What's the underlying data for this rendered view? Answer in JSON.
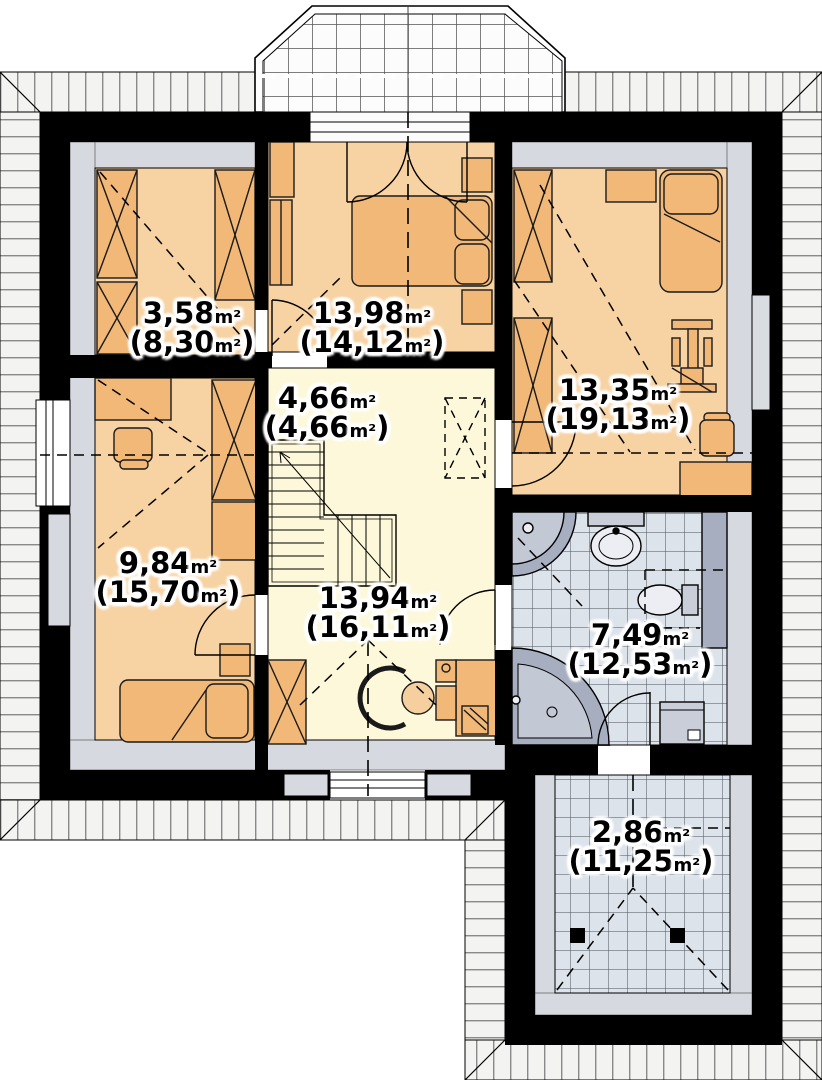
{
  "plan": {
    "type": "floor-plan",
    "floor": "attic storey",
    "rooms": [
      {
        "name": "closet",
        "area_value": "3,58",
        "area_unit": "m²",
        "total_open": "(8,30",
        "total_unit": "m²",
        "total_close": ")"
      },
      {
        "name": "bedroom-top",
        "area_value": "13,98",
        "area_unit": "m²",
        "total_open": "(14,12",
        "total_unit": "m²",
        "total_close": ")"
      },
      {
        "name": "stair-hall",
        "area_value": "4,66",
        "area_unit": "m²",
        "total_open": "(4,66",
        "total_unit": "m²",
        "total_close": ")"
      },
      {
        "name": "bedroom-right",
        "area_value": "13,35",
        "area_unit": "m²",
        "total_open": "(19,13",
        "total_unit": "m²",
        "total_close": ")"
      },
      {
        "name": "bedroom-left",
        "area_value": "9,84",
        "area_unit": "m²",
        "total_open": "(15,70",
        "total_unit": "m²",
        "total_close": ")"
      },
      {
        "name": "hall",
        "area_value": "13,94",
        "area_unit": "m²",
        "total_open": "(16,11",
        "total_unit": "m²",
        "total_close": ")"
      },
      {
        "name": "bathroom",
        "area_value": "7,49",
        "area_unit": "m²",
        "total_open": "(12,53",
        "total_unit": "m²",
        "total_close": ")"
      },
      {
        "name": "loggia",
        "area_value": "2,86",
        "area_unit": "m²",
        "total_open": "(11,25",
        "total_unit": "m²",
        "total_close": ")"
      }
    ],
    "symbols": [
      "wardrobe-icon",
      "double-bed-icon",
      "single-bed-icon",
      "nightstand-icon",
      "desk-icon",
      "office-chair-icon",
      "easel-icon",
      "stairs",
      "door-arc",
      "window",
      "balcony-door",
      "shower-icon",
      "sink-icon",
      "toilet-icon",
      "corner-bathtub-icon",
      "washing-machine-icon",
      "column-post",
      "roof-hatch",
      "dormer-window",
      "section-line"
    ],
    "colors": {
      "wall": "#000000",
      "roof_hatch_bg": "#f3f3f2",
      "hatch_line": "#8a8a8a",
      "knee_wall_gray": "#d6d9df",
      "bedroom_floor": "#f7d2a2",
      "hall_floor": "#fcf8d9",
      "tile_floor": "#dde3eb",
      "furniture": "#f2b878",
      "fixture_light": "#c9ced9",
      "fixture_dark": "#a7aec0",
      "label_halo": "#ffffff"
    }
  }
}
